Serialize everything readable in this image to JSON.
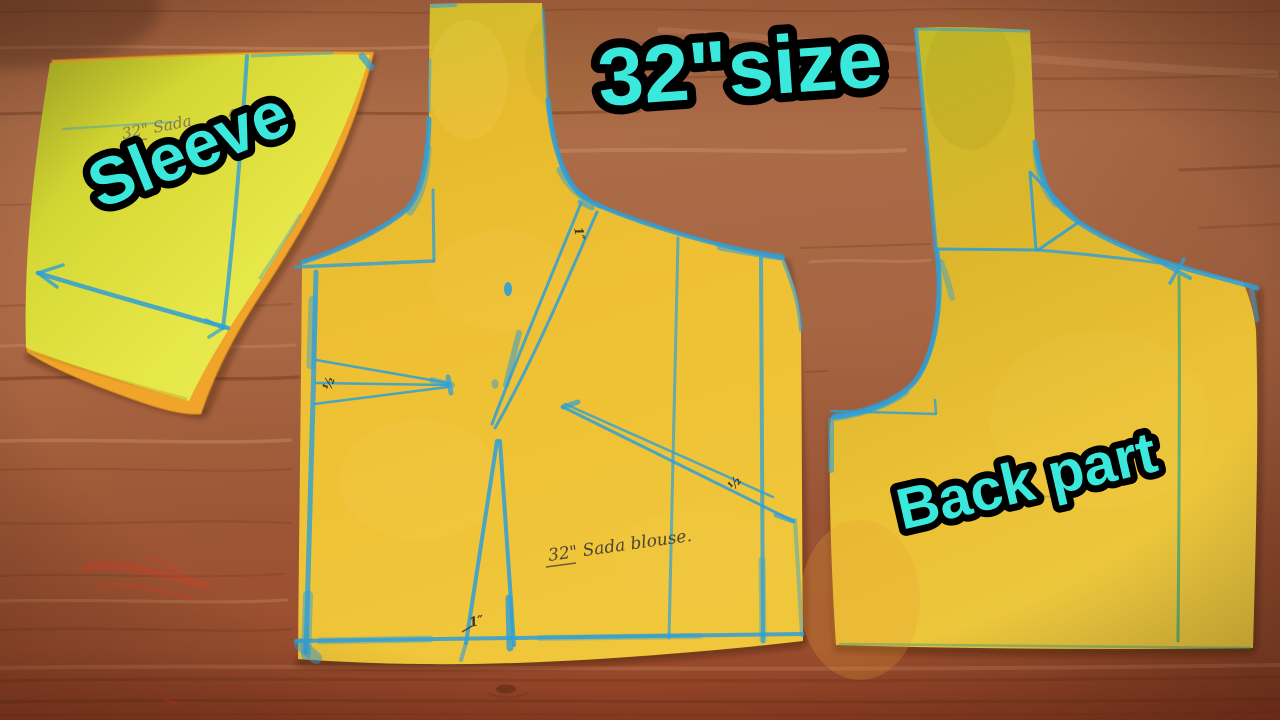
{
  "scene": {
    "description": "Three yellow paper blouse sewing-pattern pieces with blue tailor's chalk markings laid on a brown wooden table",
    "title": "32\"size",
    "pieces": {
      "sleeve": {
        "name": "Sleeve pattern piece",
        "label": "Sleeve",
        "note": "32\" Sada"
      },
      "front": {
        "name": "Front bodice pattern piece",
        "note": "32\" Sada blouse.",
        "marks": [
          "½",
          "½",
          "1″",
          "1″"
        ]
      },
      "back": {
        "name": "Back bodice pattern piece",
        "label": "Back part"
      }
    },
    "colors": {
      "label_cyan": "#3BE9DC",
      "label_outline": "#000000",
      "chalk_blue": "#2E9FD8",
      "chalk_teal": "#2FA183",
      "chalk_red": "#E23B28",
      "paper_yellow": "#EFBE31",
      "paper_sleeve": "#E2E23D",
      "paper_underlay": "#F0A42A",
      "wood_brown": "#A96745",
      "pencil": "#4A4336"
    }
  }
}
